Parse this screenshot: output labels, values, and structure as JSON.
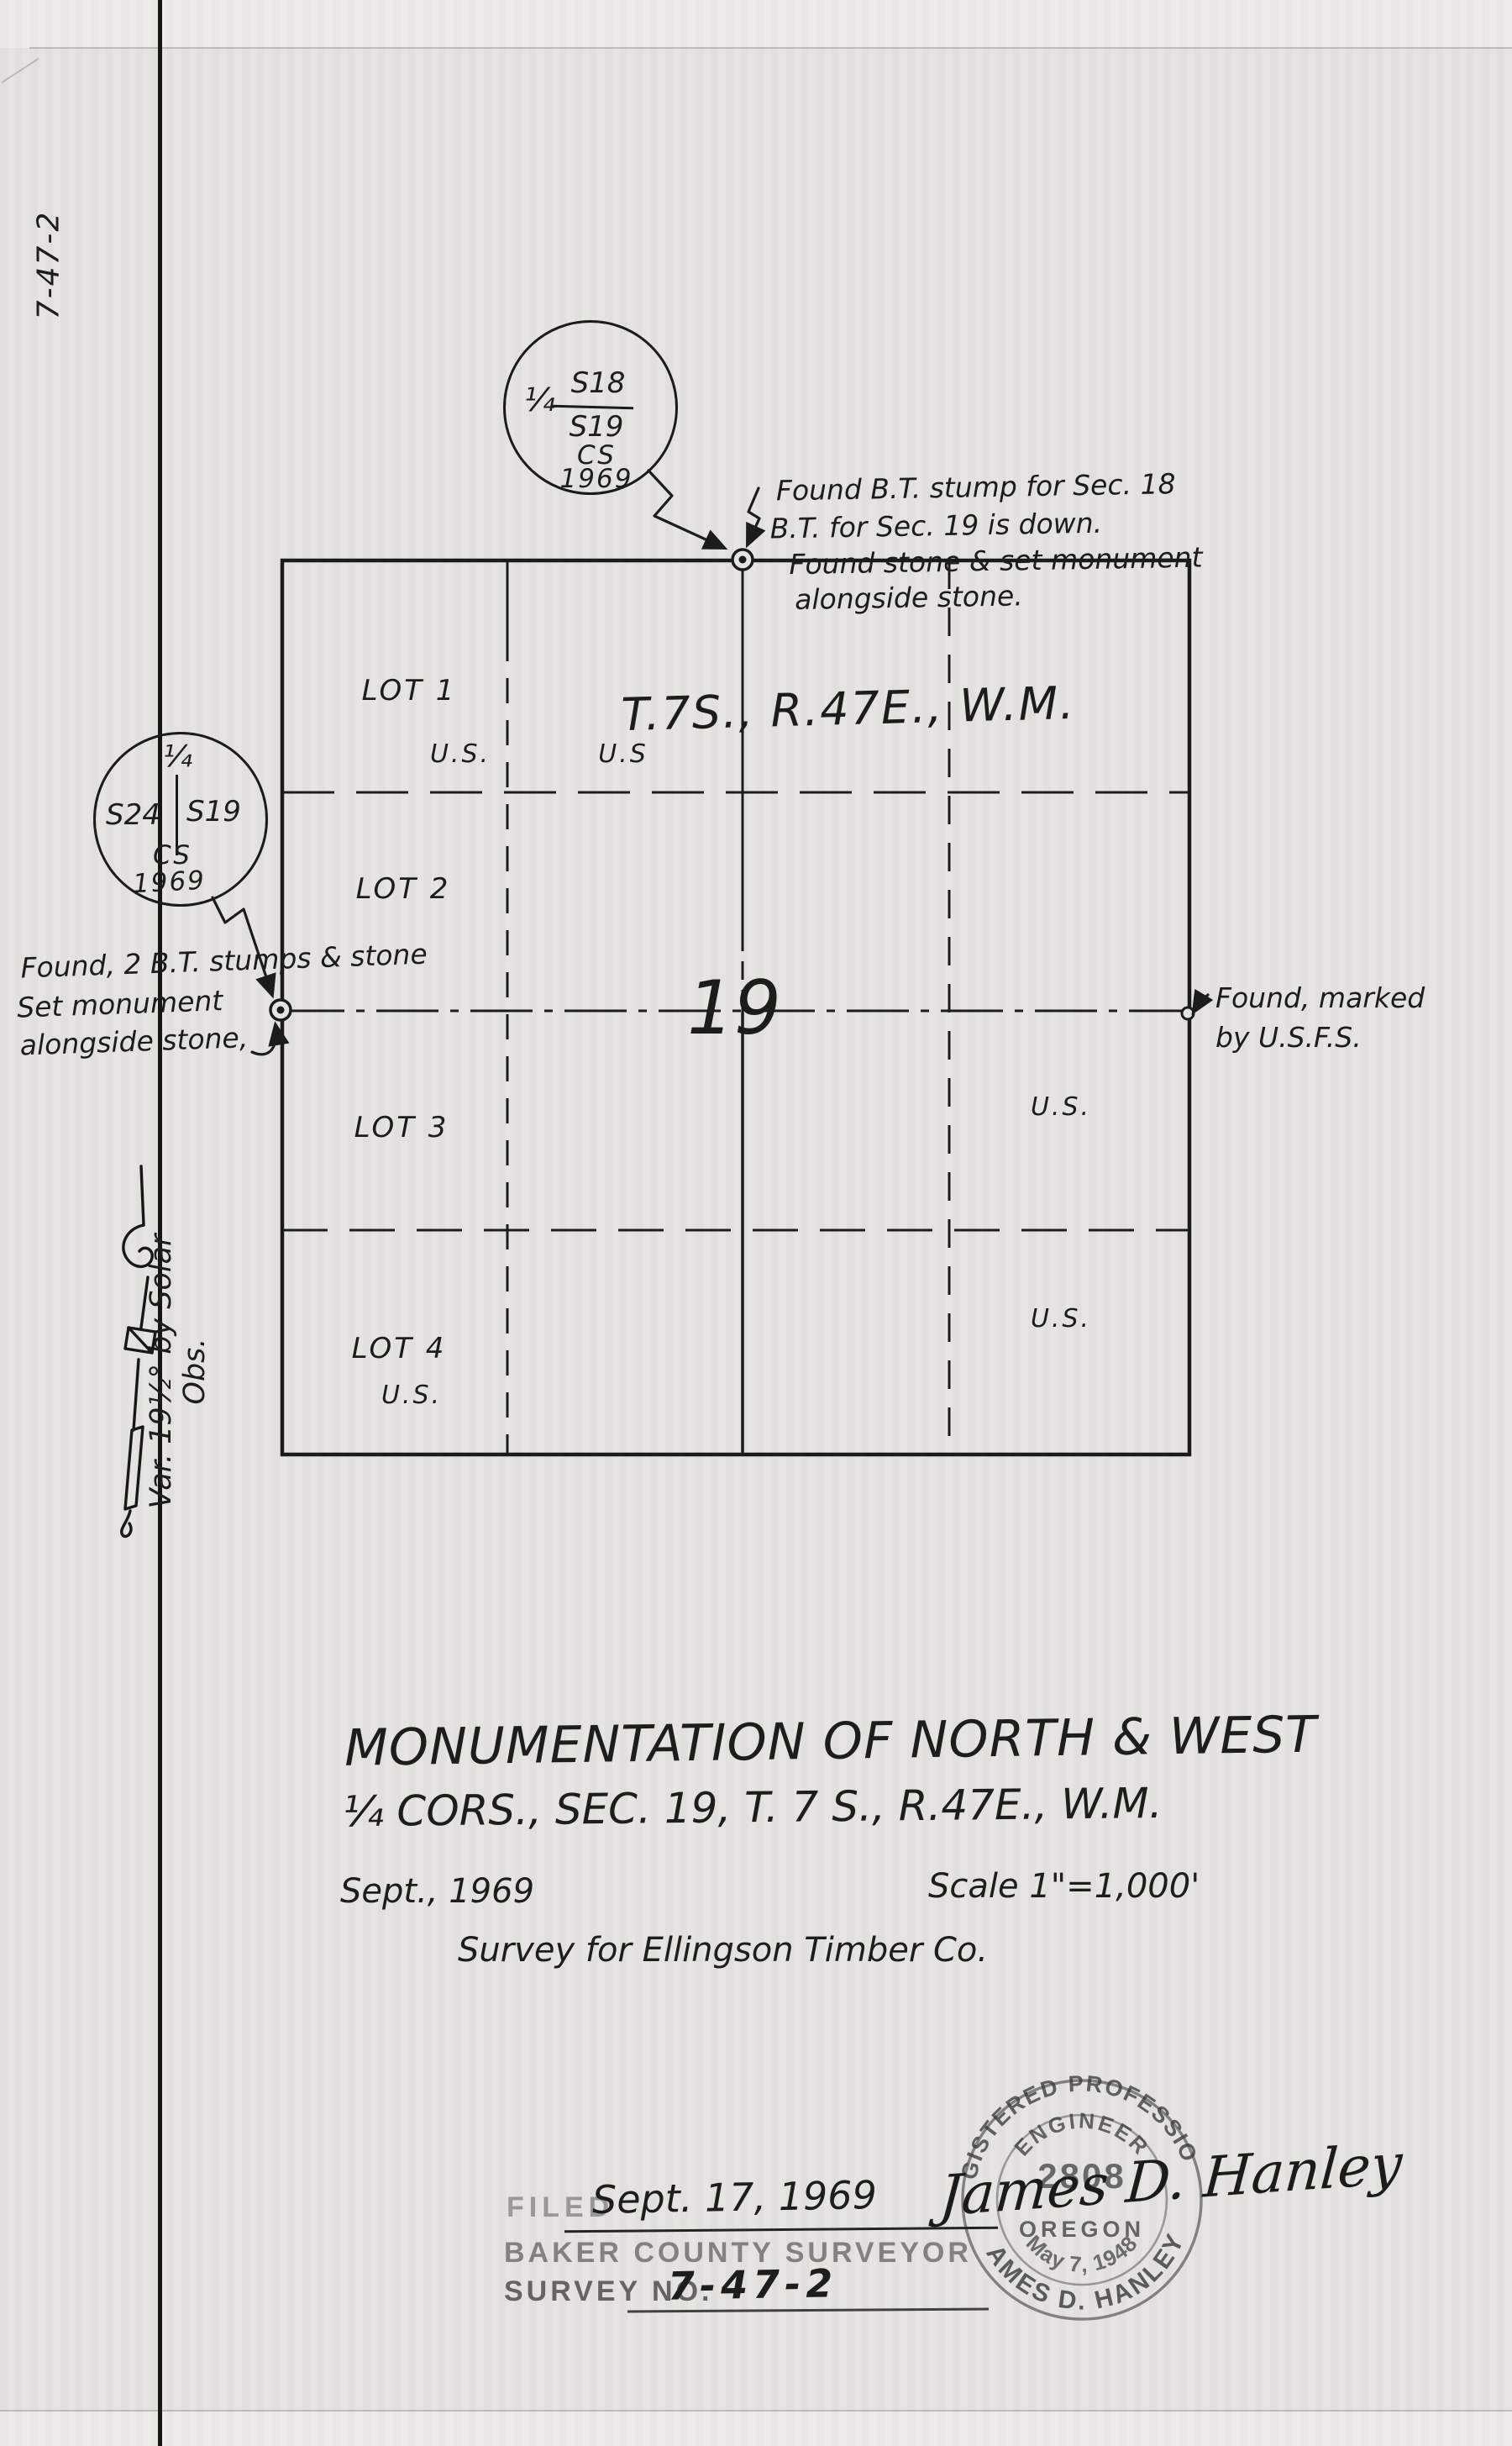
{
  "sheet": {
    "margin_number": "7-47-2",
    "variation_note": "Var. 19½° by Solar Obs."
  },
  "corner_circles": {
    "north": {
      "quarter": "¼",
      "over": "S18",
      "under": "S19",
      "cs": "CS",
      "year": "1969"
    },
    "west": {
      "quarter": "¼",
      "left": "S24",
      "right": "S19",
      "cs": "CS",
      "year": "1969"
    }
  },
  "notes": {
    "north": [
      "Found B.T. stump for Sec. 18",
      "B.T. for Sec. 19 is down.",
      "Found stone & set monument",
      "alongside stone."
    ],
    "west": [
      "Found, 2 B.T. stumps & stone",
      "Set monument",
      "alongside stone,"
    ],
    "east": [
      "Found, marked",
      "by U.S.F.S."
    ]
  },
  "plat": {
    "township": "T.7S., R.47E., W.M.",
    "section": "19",
    "lot1": "LOT 1",
    "lot2": "LOT 2",
    "lot3": "LOT 3",
    "lot4": "LOT 4",
    "us_lot1": "U.S.",
    "us_nw": "U.S",
    "us_lot4": "U.S.",
    "us_east_upper": "U.S.",
    "us_east_lower": "U.S."
  },
  "title_block": {
    "line1": "MONUMENTATION OF NORTH & WEST",
    "line2": "¼ CORS., SEC. 19, T. 7 S., R.47E., W.M.",
    "date": "Sept., 1969",
    "scale": "Scale 1\"=1,000'",
    "client": "Survey for Ellingson Timber Co."
  },
  "filing": {
    "filed_label": "FILED",
    "filed_date": "Sept. 17, 1969",
    "office": "BAKER COUNTY SURVEYOR",
    "survey_no_label": "SURVEY NO.",
    "survey_no": "7-47-2"
  },
  "seal": {
    "arc_top": "REGISTERED PROFESSIONAL",
    "arc_engineer": "ENGINEER",
    "number": "2808",
    "signature": "James D. Hanley",
    "state": "OREGON",
    "reg_date": "May 7, 1948",
    "arc_bottom": "JAMES D. HANLEY"
  },
  "colors": {
    "paper": "#e5e3e0",
    "ink": "#1c1c1c",
    "stamp": "#3f3f3f"
  }
}
